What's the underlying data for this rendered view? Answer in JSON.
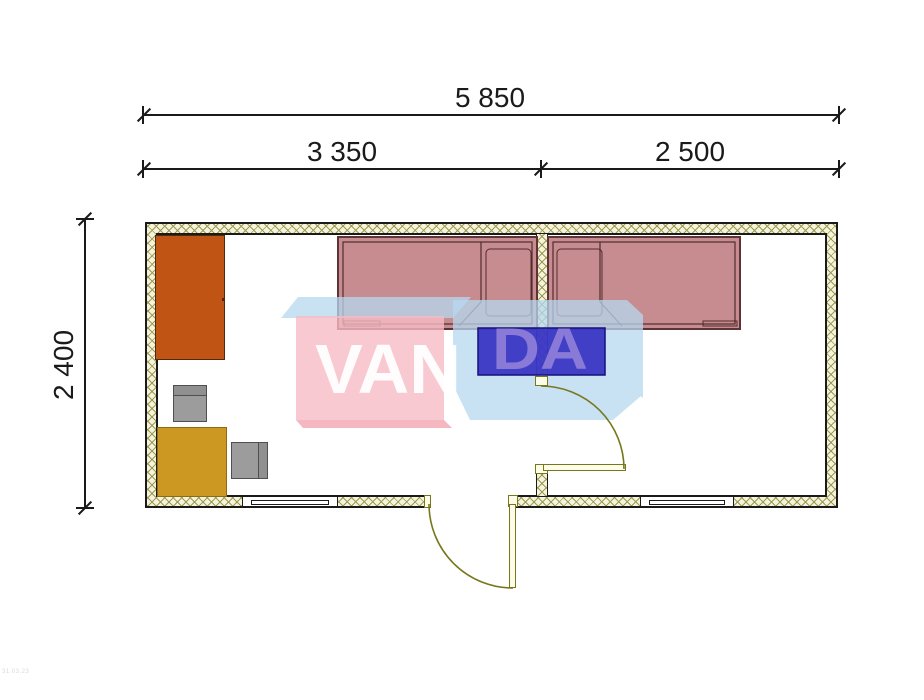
{
  "dimensions": {
    "total": "5 850",
    "left_room": "3 350",
    "right_room": "2 500",
    "depth": "2 400"
  },
  "watermark": {
    "van": "VAN",
    "da": "DA"
  },
  "corner_note": "31.03.23",
  "colors": {
    "line": "#1a1a1a",
    "hatch-bg": "#f6f3dd",
    "hatch-line": "#9a9a52",
    "wardrobe": "#bf5414",
    "table": "#cd9822",
    "furn-gray": "#9c9c9c",
    "furn-gray-line": "#4f4f4f",
    "bed-fill": "rgba(168,80,86,0.66)",
    "bed-line": "#5d3338",
    "bed-detail": "rgba(70,32,36,0.9)",
    "nightstand-blue": "#2e26c0",
    "nightstand-line": "#16107a",
    "door-olive": "#77771d",
    "door-fill": "#fcfce8",
    "wm-pink": "rgba(246,187,196,0.8)",
    "wm-pink-deep": "rgba(242,166,177,0.8)",
    "wm-blue": "rgba(182,216,240,0.75)",
    "wm-letters": "#8d7ed9"
  }
}
